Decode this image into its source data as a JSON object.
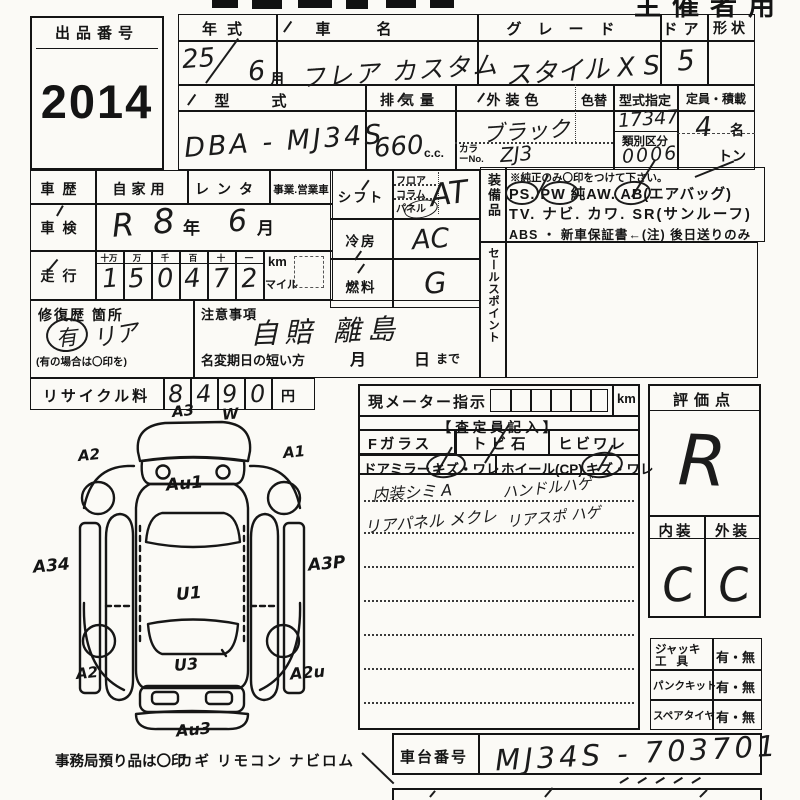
{
  "stamp": "主催者用",
  "lot": {
    "label": "出品番号",
    "number": "2014"
  },
  "t1": {
    "year_label": "年式",
    "name_label": "車名",
    "grade_label": "グレード",
    "door_label": "ドア",
    "shape_label": "形状",
    "year": "25",
    "month": "6",
    "month_unit": "月",
    "name": "フレア カスタム",
    "grade": "スタイル X S",
    "door": "5",
    "model_label": "型式",
    "disp_label": "排気量",
    "color_label": "外装色",
    "colorchg_label": "色替",
    "typedesig_label": "型式指定",
    "capacity_label": "定員・積載",
    "model": "DBA - MJ34S",
    "disp": "660",
    "disp_unit": "c.c.",
    "color": "ブラック",
    "color_no_label": "カラーNo.",
    "color_no": "ZJ3",
    "typedesig": "17347",
    "class_label": "類別区分",
    "class_no": "0006",
    "capacity": "4",
    "capacity_unit": "名",
    "ton": "トン"
  },
  "hist": {
    "label": "車歴",
    "opt1": "自家用",
    "opt2": "レンタ",
    "opt3": "事業.営業車"
  },
  "insp": {
    "label": "車検",
    "era": "R",
    "year": "8",
    "year_unit": "年",
    "month": "6",
    "month_unit": "月"
  },
  "mil": {
    "label": "走行",
    "h1": "十万",
    "h2": "万",
    "h3": "千",
    "h4": "百",
    "h5": "十",
    "h6": "一",
    "d1": "1",
    "d2": "5",
    "d3": "0",
    "d4": "4",
    "d5": "7",
    "d6": "2",
    "km": "km",
    "mile": "マイル"
  },
  "shift": {
    "label": "シフト",
    "o1": "フロア",
    "o2": "コラム",
    "o3": "パネル",
    "val": "AT"
  },
  "ac": {
    "label": "冷房",
    "val": "AC"
  },
  "fuel": {
    "label": "燃料",
    "val": "G"
  },
  "equip": {
    "label": "装備品",
    "note": "※純正のみ〇印をつけて下さい。",
    "ps": "PS",
    "d1": ". ",
    "pw": "PW",
    "aw": " 純AW. ",
    "ab": "AB",
    "absuf": "(エアバッグ)",
    "line2": "TV. ナビ. カワ. SR(サンルーフ)",
    "line3": "ABS ・ 新車保証書←(注) 後日送りのみ"
  },
  "sales": {
    "label": "セールスポイント"
  },
  "repair": {
    "label": "修復歴 箇所",
    "mark": "有",
    "note": "リア",
    "hint": "(有の場合は〇印を)"
  },
  "caution": {
    "label": "注意事項",
    "val": "自賠 離島",
    "sub": "名変期日の短い方",
    "m": "月",
    "d": "日",
    "made": "まで"
  },
  "recycle": {
    "label": "リサイクル料",
    "d1": "8",
    "d2": "4",
    "d3": "9",
    "d4": "0",
    "yen": "円"
  },
  "meter": {
    "label": "現メーター指示",
    "km": "km"
  },
  "assess": {
    "header": "【査定員記入】",
    "fg": "Fガラス",
    "fg1": "トビ石",
    "fg2": "ヒビワレ",
    "mirror": "ドアミラー",
    "wheel": "ホイール(CP)",
    "kizu": "キズ",
    "dot": "・",
    "ware": "ワレ",
    "n1a": "内装シミ A",
    "n1b": "ハンドルハゲ",
    "n2a": "リアパネル メクレ",
    "n2b": "リアスポ ハゲ"
  },
  "eval": {
    "label": "評価点",
    "score": "R",
    "int_label": "内装",
    "ext_label": "外装",
    "int": "C",
    "ext": "C"
  },
  "acc": {
    "l1a": "ジャッキ",
    "l1b": "工具",
    "v1": "有・無",
    "l2": "パンクキット",
    "v2": "有・無",
    "l3": "スペアタイヤ",
    "v3": "有・無"
  },
  "chassis": {
    "label": "車台番号",
    "val": "MJ34S - 703701"
  },
  "office": {
    "note": "事務局預り品は〇印",
    "items": "カギ リモコン ナビロム"
  },
  "codes": {
    "a3": "A3",
    "w": "W",
    "a2f": "A2",
    "a1": "A1",
    "au1": "Au1",
    "a34": "A34",
    "a3p": "A3P",
    "u1": "U1",
    "a2r": "A2",
    "u3": "U3",
    "a2u": "A2u",
    "au3": "Au3"
  }
}
